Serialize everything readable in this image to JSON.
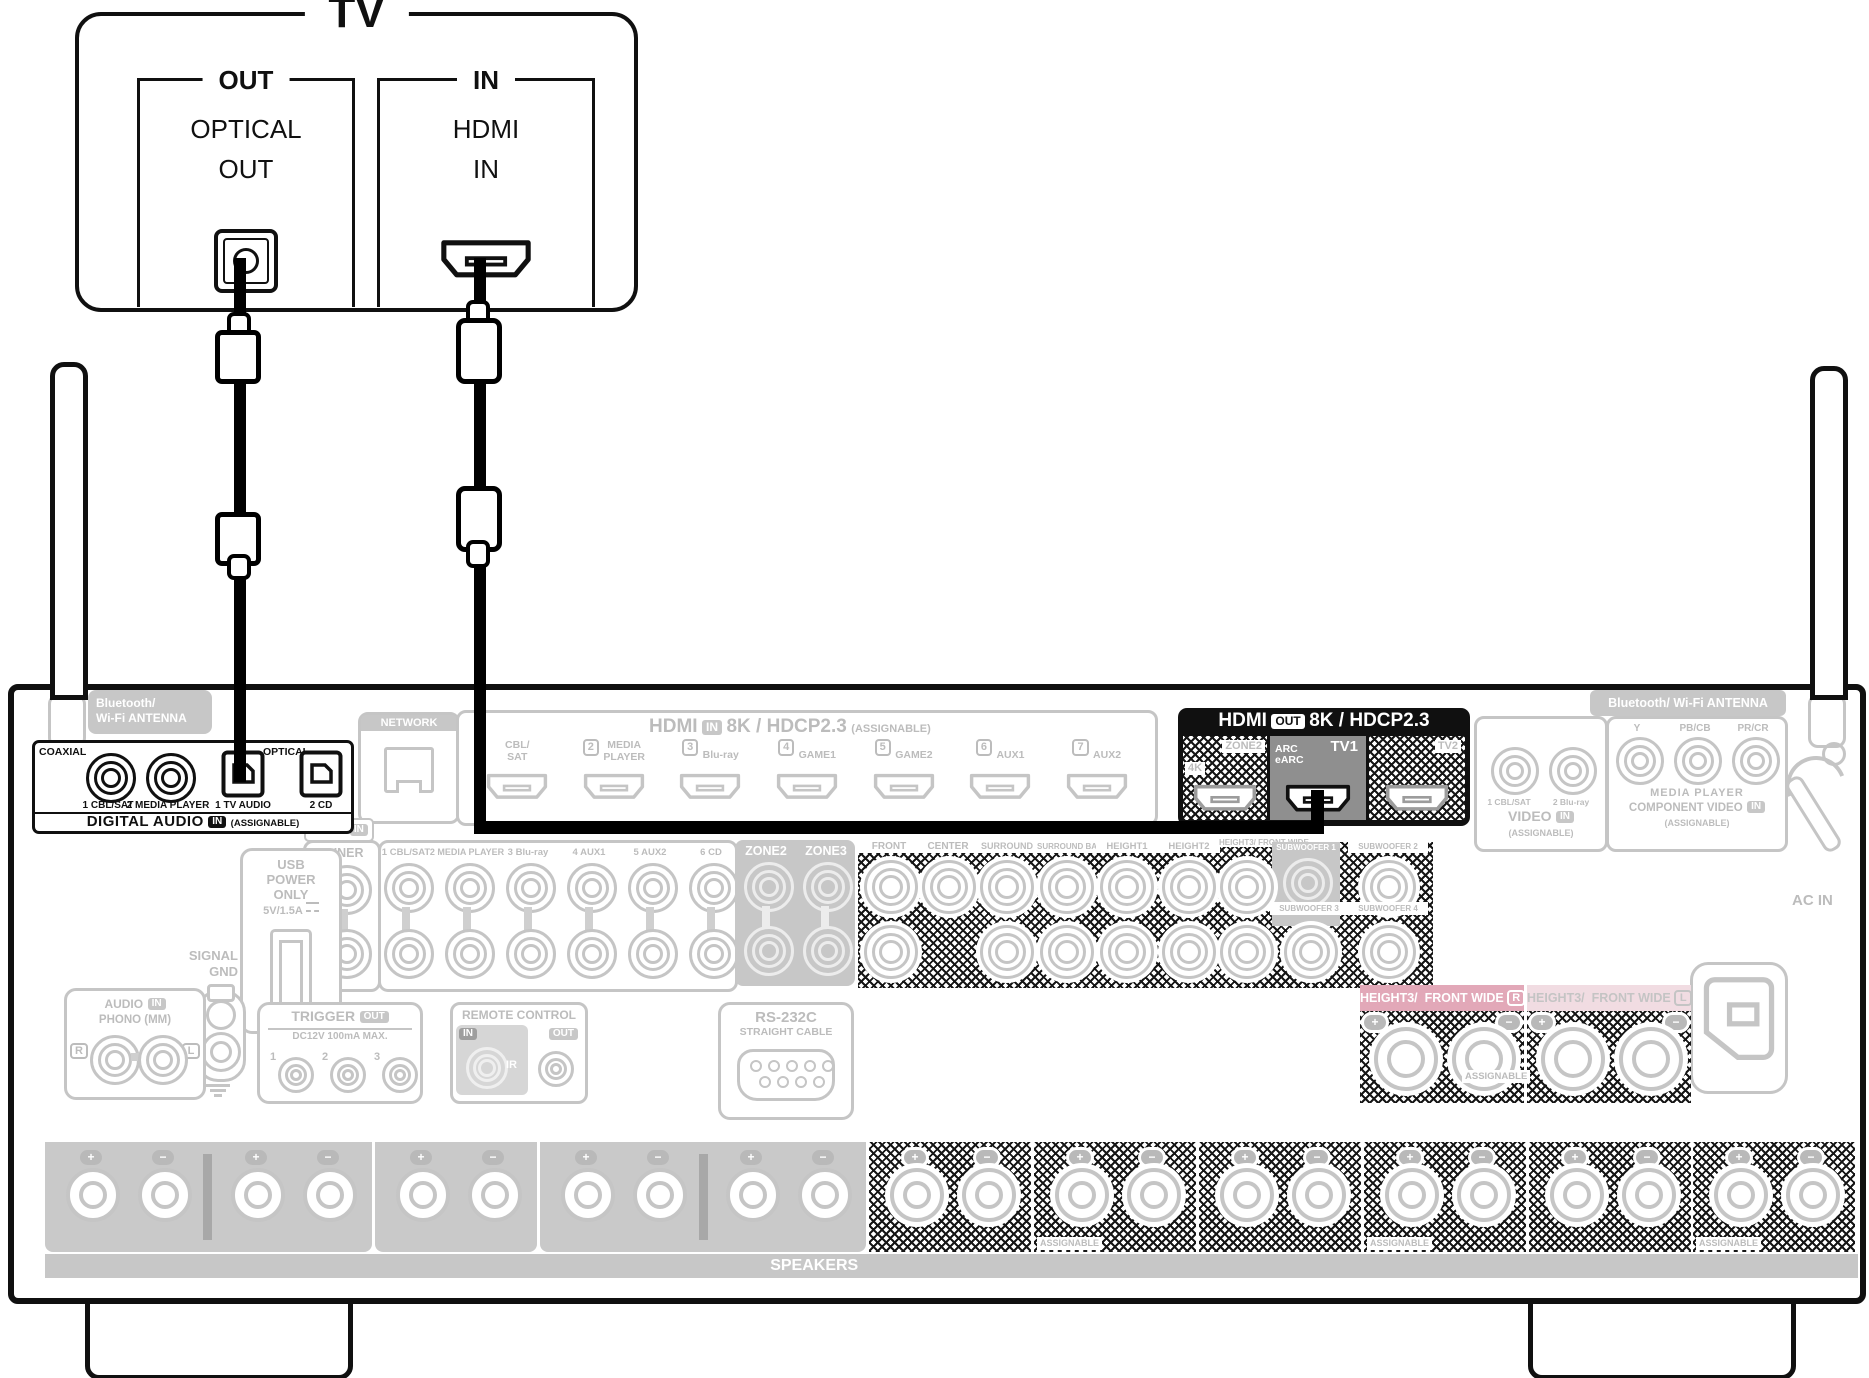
{
  "tv": {
    "title": "TV",
    "out_group": "OUT",
    "optical_port": "OPTICAL\nOUT",
    "in_group": "IN",
    "hdmi_port": "HDMI\nIN"
  },
  "receiver": {
    "antenna_left": "Bluetooth/\nWi-Fi ANTENNA",
    "antenna_right": "Bluetooth/ Wi-Fi ANTENNA",
    "digital_audio": {
      "coaxial": "COAXIAL",
      "optical": "OPTICAL",
      "jacks": [
        "1 CBL/SAT",
        "2 MEDIA PLAYER",
        "1 TV AUDIO",
        "2 CD"
      ],
      "title": "DIGITAL AUDIO",
      "in_badge": "IN",
      "assignable": "(ASSIGNABLE)"
    },
    "network": "NETWORK",
    "hdmi_in": {
      "title": "HDMI",
      "in_badge": "IN",
      "spec": "8K / HDCP2.3",
      "assignable": "(ASSIGNABLE)",
      "ports": [
        {
          "num": "",
          "label": "CBL/\nSAT"
        },
        {
          "num": "2",
          "label": "MEDIA\nPLAYER"
        },
        {
          "num": "3",
          "label": "Blu-ray"
        },
        {
          "num": "4",
          "label": "GAME1"
        },
        {
          "num": "5",
          "label": "GAME2"
        },
        {
          "num": "6",
          "label": "AUX1"
        },
        {
          "num": "7",
          "label": "AUX2"
        }
      ]
    },
    "hdmi_out": {
      "title": "HDMI",
      "out_badge": "OUT",
      "spec": "8K / HDCP2.3",
      "monitor_side": "4K",
      "monitor_top": "ZONE2",
      "arc": "ARC\neARC",
      "main": "TV1",
      "second": "TV2"
    },
    "video_in": {
      "jacks": [
        "1 CBL/SAT",
        "2 Blu-ray"
      ],
      "title": "VIDEO",
      "in_badge": "IN",
      "assignable": "(ASSIGNABLE)"
    },
    "component": {
      "channels": [
        "Y",
        "PB/CB",
        "PR/CR"
      ],
      "device": "MEDIA PLAYER",
      "title": "COMPONENT VIDEO",
      "in_badge": "IN",
      "assignable": "(ASSIGNABLE)"
    },
    "audio_in": {
      "tag": "AUDIO",
      "in_badge": "IN",
      "tuner": "TUNER",
      "left": "L",
      "right": "R",
      "columns": [
        "1 CBL/SAT",
        "2 MEDIA PLAYER",
        "3 Blu-ray",
        "4 AUX1",
        "5 AUX2",
        "6 CD"
      ]
    },
    "zones": [
      "ZONE2",
      "ZONE3"
    ],
    "preout_cols": [
      "FRONT",
      "CENTER",
      "SURROUND",
      "SURROUND BACK",
      "HEIGHT1",
      "HEIGHT2",
      "HEIGHT3/\nFRONT WIDE"
    ],
    "subs": [
      "SUBWOOFER 1",
      "SUBWOOFER 2",
      "SUBWOOFER 3",
      "SUBWOOFER 4"
    ],
    "usb": {
      "l1": "USB",
      "l2": "POWER",
      "l3": "ONLY",
      "rating": "5V/1.5A"
    },
    "signal_gnd": "SIGNAL\nGND",
    "phono": {
      "tag": "AUDIO",
      "in_badge": "IN",
      "label": "PHONO (MM)",
      "r": "R",
      "l": "L"
    },
    "trigger": {
      "title": "TRIGGER",
      "out_badge": "OUT",
      "spec": "DC12V 100mA MAX.",
      "jacks": [
        "1",
        "2",
        "3"
      ]
    },
    "remote": {
      "title": "REMOTE CONTROL",
      "in_badge": "IN",
      "ir": "IR",
      "out_badge": "OUT"
    },
    "rs232": {
      "title": "RS-232C",
      "subtitle": "STRAIGHT CABLE"
    },
    "ac_in": "AC IN",
    "speakers": {
      "footer": "SPEAKERS",
      "assignable": "ASSIGNABLE",
      "plus": "+",
      "minus": "−",
      "sections": [
        {
          "label": "FRONT",
          "ch": "R",
          "color": "#E7A28B"
        },
        {
          "label": "FRONT",
          "ch": "L",
          "color": "#F6F1EC"
        },
        {
          "label": "CENTER",
          "ch": "",
          "color": "#B7D0A4"
        },
        {
          "label": "SURROUND",
          "ch": "R",
          "color": "#C2DFEA"
        },
        {
          "label": "SURROUND",
          "ch": "L",
          "color": "#DEEDF4"
        },
        {
          "label": "SURROUND BACK",
          "ch": "R",
          "color": "#CFA368"
        },
        {
          "label": "SURROUND BACK",
          "ch": "L",
          "color": "#E8DAC5"
        },
        {
          "label": "HEIGHT1",
          "ch": "R",
          "color": "#E0BC83"
        },
        {
          "label": "HEIGHT1",
          "ch": "L",
          "color": "#F4E8C8"
        },
        {
          "label": "HEIGHT2",
          "ch": "R",
          "color": "#B5A1CE"
        },
        {
          "label": "HEIGHT2",
          "ch": "L",
          "color": "#DDD4E9"
        }
      ]
    },
    "height3_block": {
      "assignable": "ASSIGNABLE",
      "sections": [
        {
          "label": "HEIGHT3/",
          "label2": "FRONT WIDE",
          "ch": "R",
          "color": "#E2A8B8"
        },
        {
          "label": "HEIGHT3/",
          "label2": "FRONT WIDE",
          "ch": "L",
          "color": "#F1DCE2"
        }
      ]
    }
  }
}
